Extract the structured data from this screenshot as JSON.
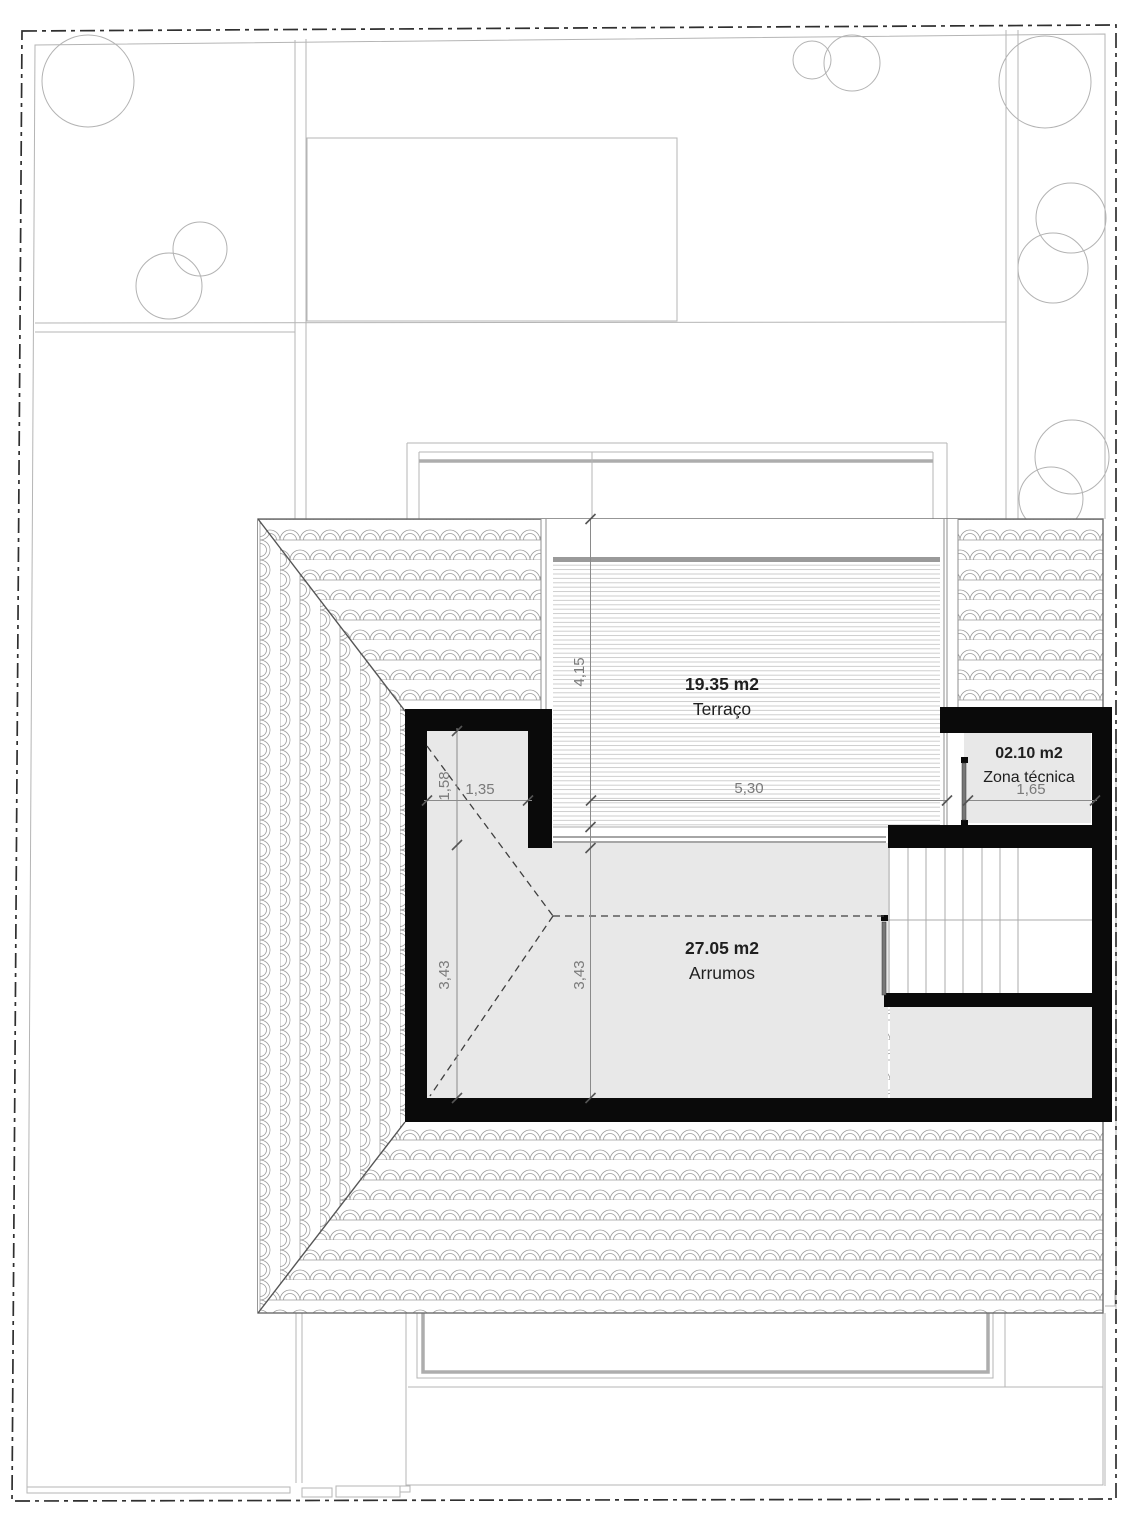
{
  "plan": {
    "rooms": [
      {
        "area": "19.35 m2",
        "name": "Terraço"
      },
      {
        "area": "02.10 m2",
        "name": "Zona técnica"
      },
      {
        "area": "27.05 m2",
        "name": "Arrumos"
      }
    ],
    "dimensions": {
      "terraco_depth": "4,15",
      "terraco_width": "5,30",
      "zona_tecnica_width": "1,65",
      "closet_width": "1,35",
      "closet_depth": "1,58",
      "arrumos_depth_left": "3,43",
      "arrumos_depth_mid": "3,43"
    },
    "colors": {
      "wall": "#0a0a0a",
      "room_fill": "#e8e8e8",
      "tile_line": "#9a9a9a",
      "dim_text": "#7a7a7a",
      "label_text": "#1f1f1f"
    }
  }
}
